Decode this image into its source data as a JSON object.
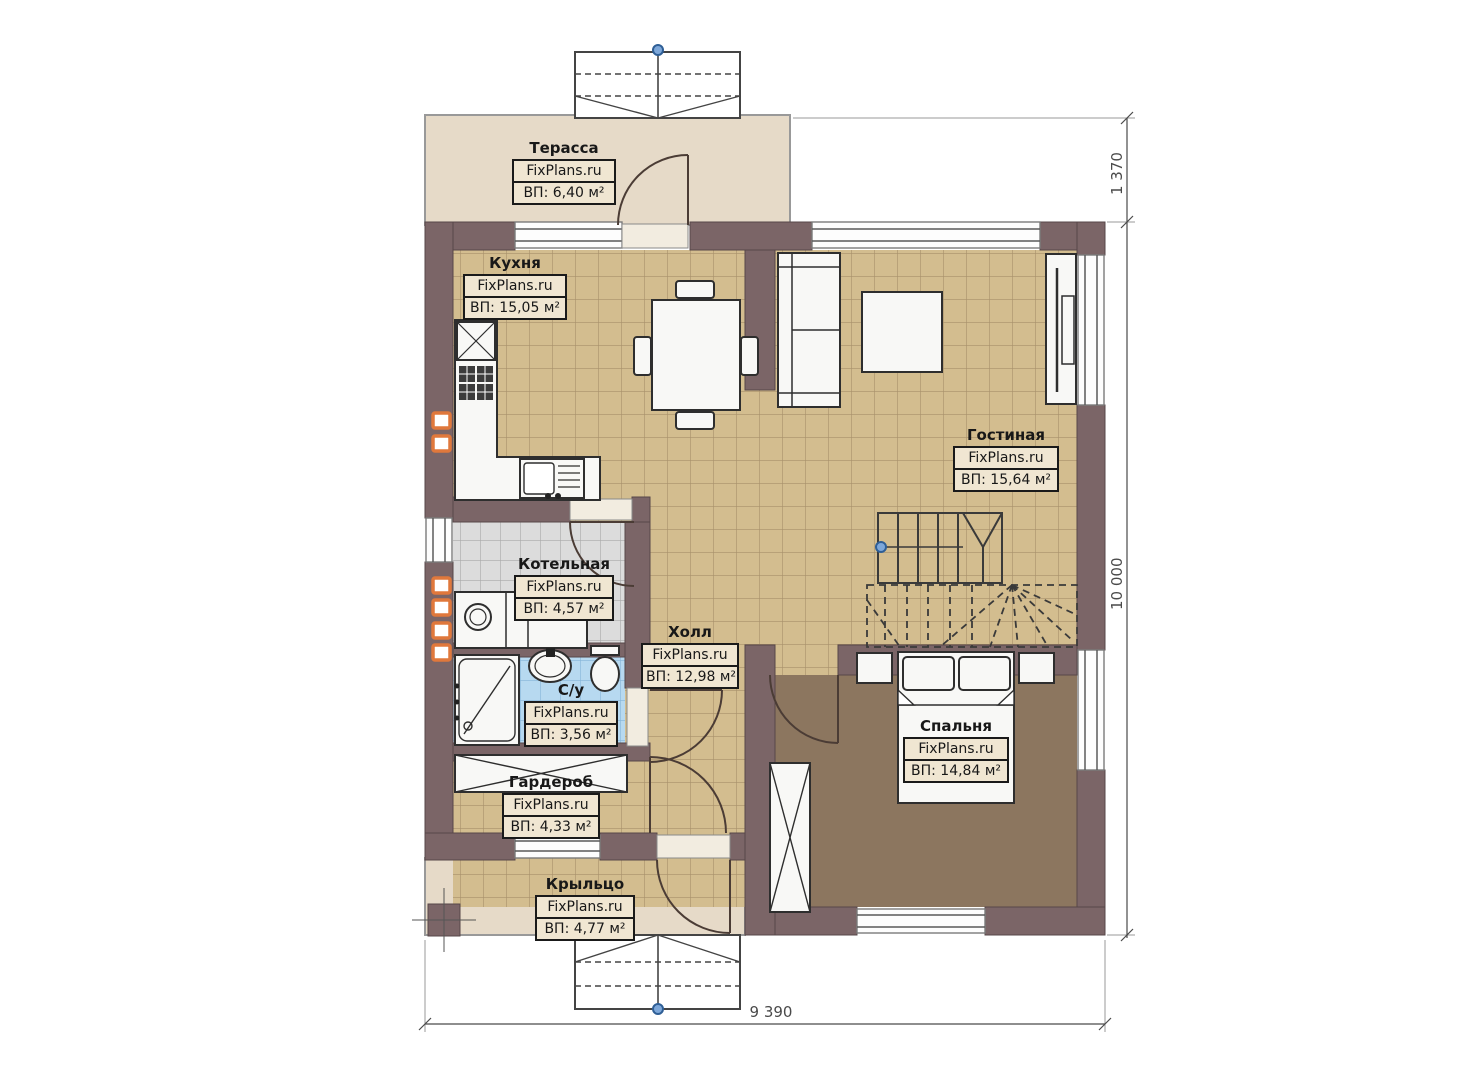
{
  "plan": {
    "watermark": "FixPlans.ru",
    "rooms": [
      {
        "id": "terrace",
        "name": "Терасса",
        "area": "ВП: 6,40 м²"
      },
      {
        "id": "kitchen",
        "name": "Кухня",
        "area": "ВП: 15,05 м²"
      },
      {
        "id": "living",
        "name": "Гостиная",
        "area": "ВП: 15,64 м²"
      },
      {
        "id": "boiler",
        "name": "Котельная",
        "area": "ВП: 4,57 м²"
      },
      {
        "id": "hall",
        "name": "Холл",
        "area": "ВП: 12,98 м²"
      },
      {
        "id": "bathroom",
        "name": "С/у",
        "area": "ВП: 3,56 м²"
      },
      {
        "id": "bedroom",
        "name": "Спальня",
        "area": "ВП: 14,84 м²"
      },
      {
        "id": "wardrobe",
        "name": "Гардероб",
        "area": "ВП: 4,33 м²"
      },
      {
        "id": "porch",
        "name": "Крыльцо",
        "area": "ВП: 4,77 м²"
      }
    ],
    "dimensions": {
      "right_top": "1 370",
      "right_total": "10 000",
      "bottom_total": "9 390"
    },
    "colors": {
      "wall": "#7b6567",
      "floor_tile_tan": "#d3bd8f",
      "floor_gray": "#dcdcdc",
      "floor_blue": "#b7d9f0",
      "floor_bedroom": "#8c765f",
      "terrace_beige": "#e6dac8",
      "vent_orange": "#e0783c",
      "node_blue": "#7da7d9"
    }
  }
}
